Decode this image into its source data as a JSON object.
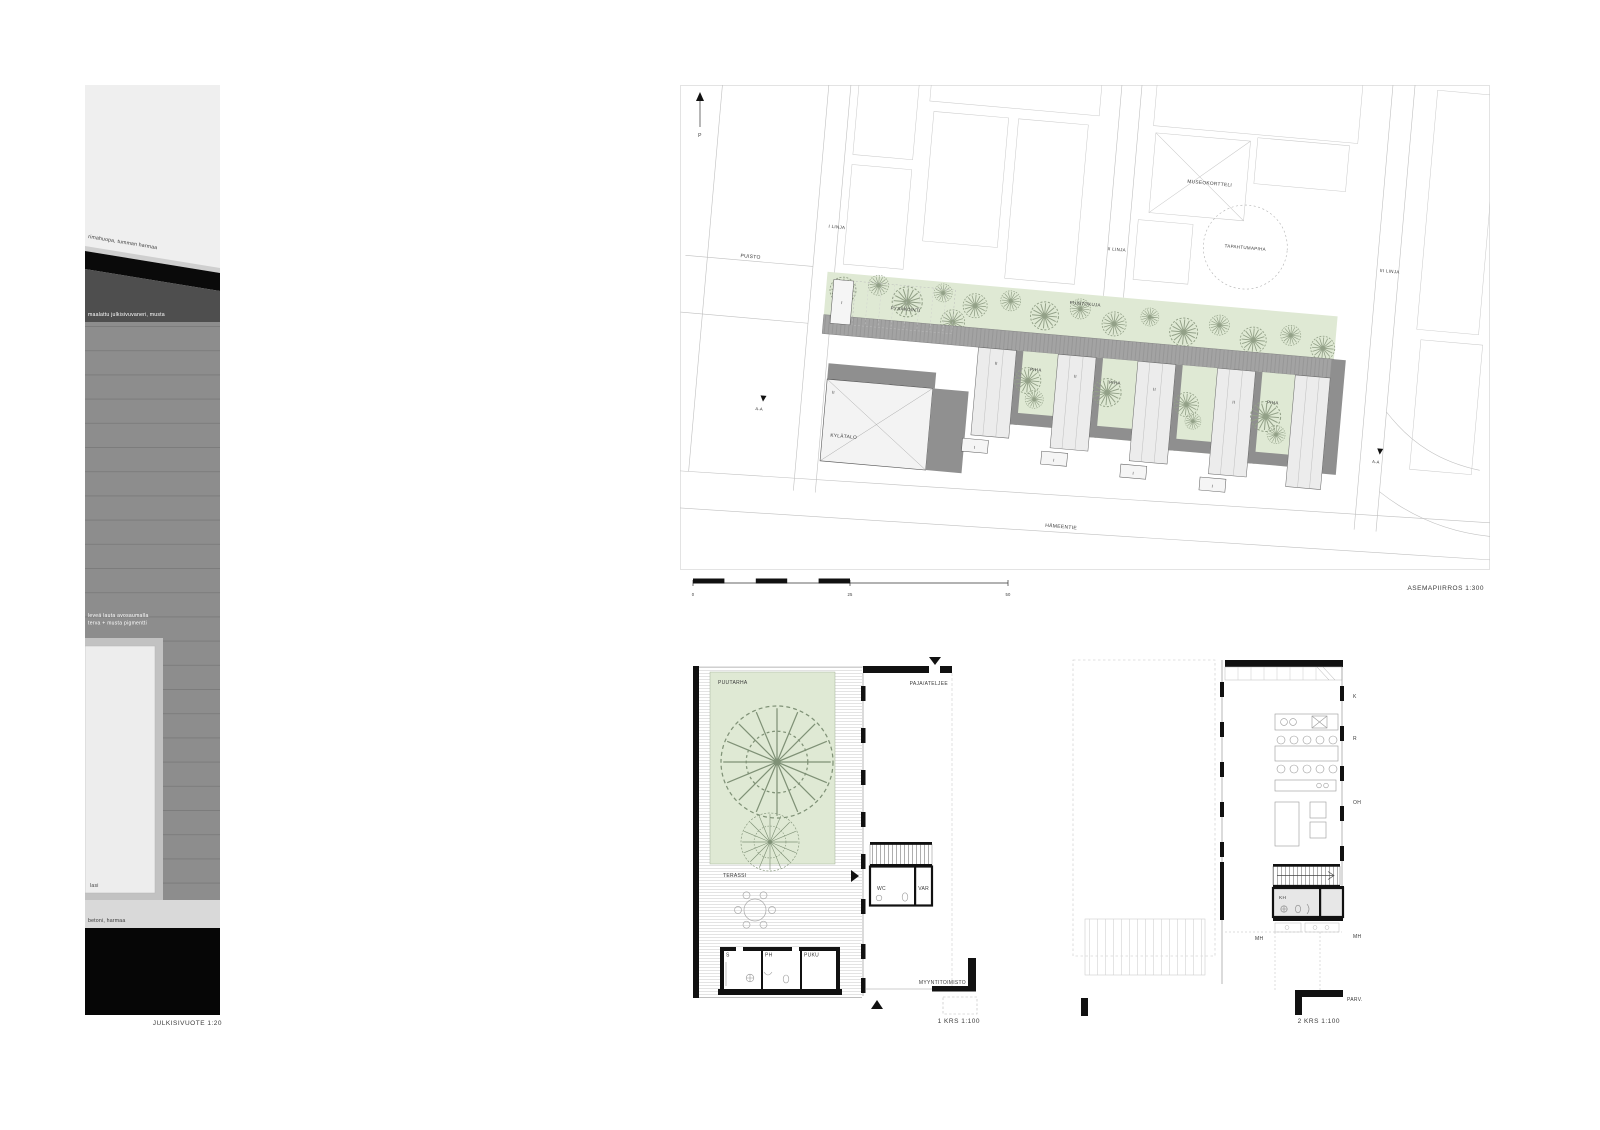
{
  "sheet": {
    "background": "#ffffff"
  },
  "captions": {
    "facade": "JULKISIVUOTE 1:20",
    "siteplan": "ASEMAPIIRROS 1:300",
    "plan1": "1 KRS 1:100",
    "plan2": "2 KRS 1:100"
  },
  "facade": {
    "labels": {
      "roof": "rimahuopa, tumman harmaa",
      "plywood": "maalattu julkisivuvaneri, musta",
      "board1": "leveä lauta avosaumalla",
      "board2": "terva + musta pigmentti",
      "glass": "lasi",
      "concrete": "betoni, harmaa"
    },
    "colors": {
      "backdrop": "#efefef",
      "roof_black": "#0a0a0a",
      "ridge_strip": "#cfcfcf",
      "plywood": "#4e4e4e",
      "boards": "#8d8d8d",
      "joint": "#7c7c7c",
      "window_frame": "#c2c2c2",
      "glass": "#ededed",
      "concrete": "#d9d9d9",
      "base": "#060606"
    }
  },
  "siteplan": {
    "north_label": "P",
    "labels": {
      "puisto": "PUISTO",
      "i_linja": "I LINJA",
      "ii_linja": "II LINJA",
      "iii_linja": "III LINJA",
      "museokortteli": "MUSEOKORTTELI",
      "tapahtumapiha": "TAPAHTUMAPIHA",
      "puistokuja": "PUISTOKUJA",
      "pysakointi": "PYSÄKÖINTI",
      "piha": "PIHA",
      "kylatalo": "KYLÄTALO",
      "hameentie": "HÄMEENTIE",
      "section": "A-A",
      "storey_one": "I",
      "storey_two": "II"
    },
    "scalebar": {
      "zero": "0",
      "mid": "25",
      "end": "50"
    },
    "colors": {
      "green": "#dfe9d4",
      "roof": "#a3a3a3",
      "shadow": "#8f8f8f",
      "slab": "#ececec",
      "tree": "#93a188"
    }
  },
  "plan1": {
    "rooms": {
      "puutarha": "PUUTARHA",
      "paja": "PAJA/ATELJEE",
      "terassi": "TERASSI",
      "wc": "WC",
      "var": "VAR",
      "s": "S",
      "ph": "PH",
      "puku": "PUKU",
      "myyntitoimisto": "MYYNTITOIMISTO"
    }
  },
  "plan2": {
    "rooms": {
      "k": "K",
      "r": "R",
      "oh": "OH",
      "kh": "KH",
      "mh": "MH",
      "parv": "PARV."
    }
  }
}
